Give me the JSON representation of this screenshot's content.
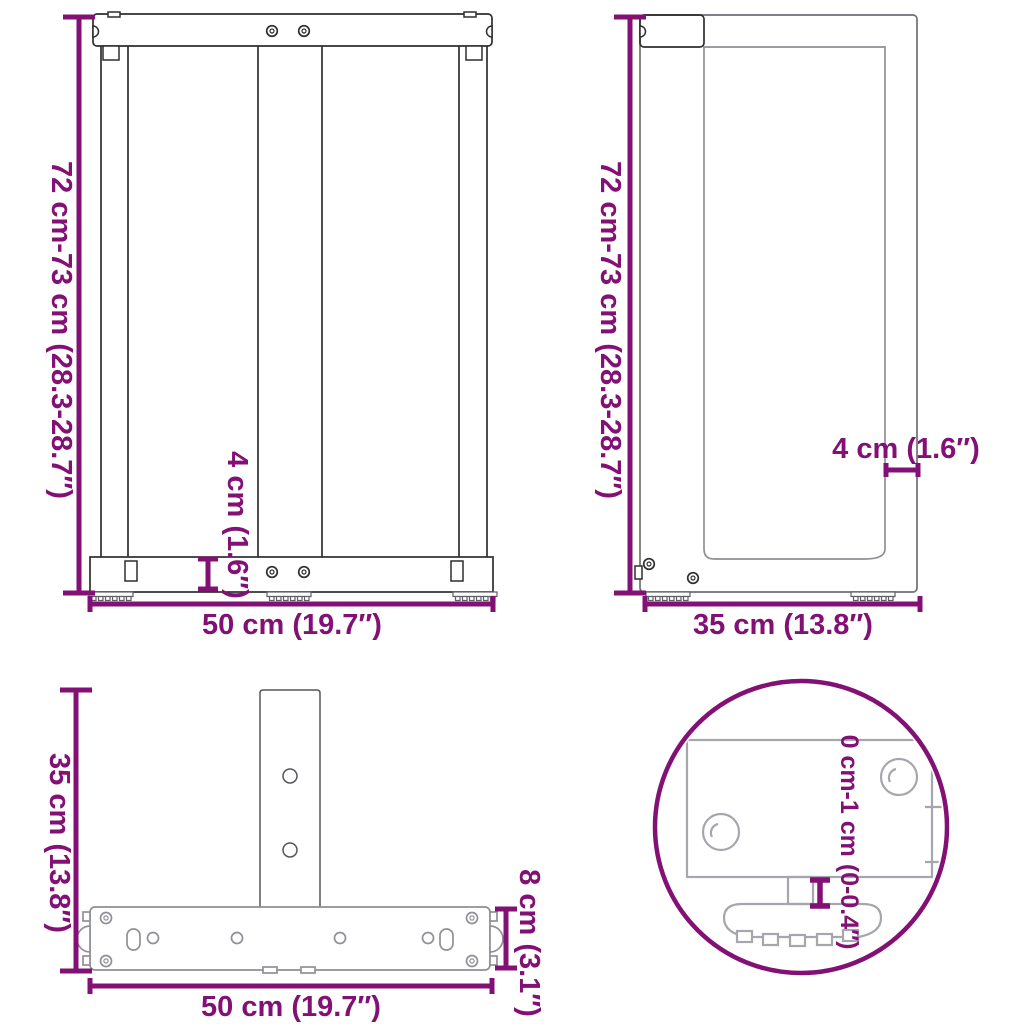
{
  "title": "T-shaped table leg dimensions diagram",
  "colors": {
    "dimension_accent": "#831175",
    "drawing_dark": "#2e2e2e",
    "drawing_light": "#8f8f97",
    "background": "#ffffff"
  },
  "views": {
    "front": {
      "name": "front view",
      "labels": {
        "height": "72 cm-73 cm (28.3-28.7″)",
        "width": "50 cm (19.7″)",
        "bar_thickness": "4 cm (1.6″)"
      }
    },
    "side": {
      "name": "side view",
      "labels": {
        "height": "72 cm-73 cm (28.3-28.7″)",
        "depth": "35 cm (13.8″)",
        "panel_thickness": "4 cm (1.6″)"
      }
    },
    "top": {
      "name": "top view",
      "labels": {
        "depth": "35 cm (13.8″)",
        "width": "50 cm (19.7″)",
        "base_depth": "8 cm (3.1″)"
      }
    },
    "detail": {
      "name": "adjustable foot detail",
      "labels": {
        "adjustment_range": "0 cm-1 cm (0-0.4″)"
      }
    }
  }
}
